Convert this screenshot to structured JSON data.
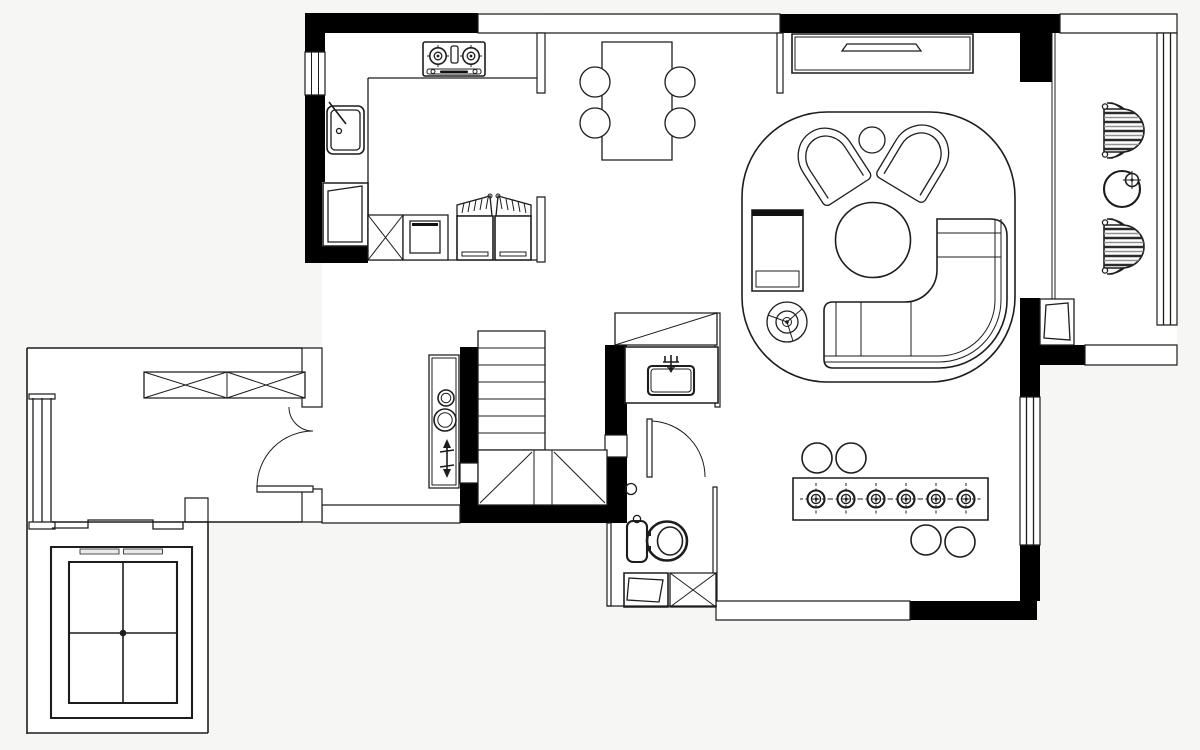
{
  "plan": {
    "type": "residential-floor-plan",
    "palette": {
      "background": "#f6f6f4",
      "floor": "#ffffff",
      "wall": "#000000",
      "line": "#1d1d1d",
      "gray": "#e9e9e9",
      "stripe_dark": "#2b2b2b",
      "stripe_mid": "#909090"
    },
    "canvas": {
      "width": 1200,
      "height": 750
    },
    "rooms": [
      {
        "id": "kitchen",
        "furniture": [
          "gas-cooktop",
          "sink",
          "tall-cabinet",
          "x-storage-cabinet",
          "oven-unit",
          "double-door-refrigerator",
          "l-shaped-counter"
        ]
      },
      {
        "id": "dining",
        "furniture": [
          "dining-table",
          "dining-chair",
          "dining-chair",
          "dining-chair",
          "dining-chair"
        ]
      },
      {
        "id": "living",
        "furniture": [
          "tv-cabinet",
          "tv",
          "area-rug",
          "armchair",
          "armchair",
          "round-side-table",
          "round-coffee-table",
          "lounge-chaise",
          "fan-lamp-symbol",
          "curved-sectional-sofa"
        ]
      },
      {
        "id": "balcony",
        "furniture": [
          "striped-lounge-chair",
          "striped-lounge-chair",
          "round-tea-table",
          "ac-unit"
        ]
      },
      {
        "id": "stair-hall",
        "furniture": [
          "staircase",
          "direction-arrow",
          "console-with-vases",
          "x-wardrobe",
          "entry-double-door"
        ]
      },
      {
        "id": "bathroom",
        "furniture": [
          "mirror-cabinet",
          "vanity-counter",
          "wash-basin",
          "faucet",
          "toilet",
          "floor-drain",
          "washing-machine",
          "x-cabinet",
          "swing-door"
        ]
      },
      {
        "id": "bar-room",
        "furniture": [
          "bar-table",
          "downlight-symbol-x6",
          "bar-stool",
          "bar-stool",
          "bar-stool",
          "bar-stool"
        ]
      },
      {
        "id": "elevator-lobby",
        "furniture": [
          "elevator-shaft",
          "elevator-car",
          "landing-steps"
        ]
      }
    ],
    "window_count": 4,
    "stair_tread_count": 7,
    "bar_downlight_count": 6
  }
}
